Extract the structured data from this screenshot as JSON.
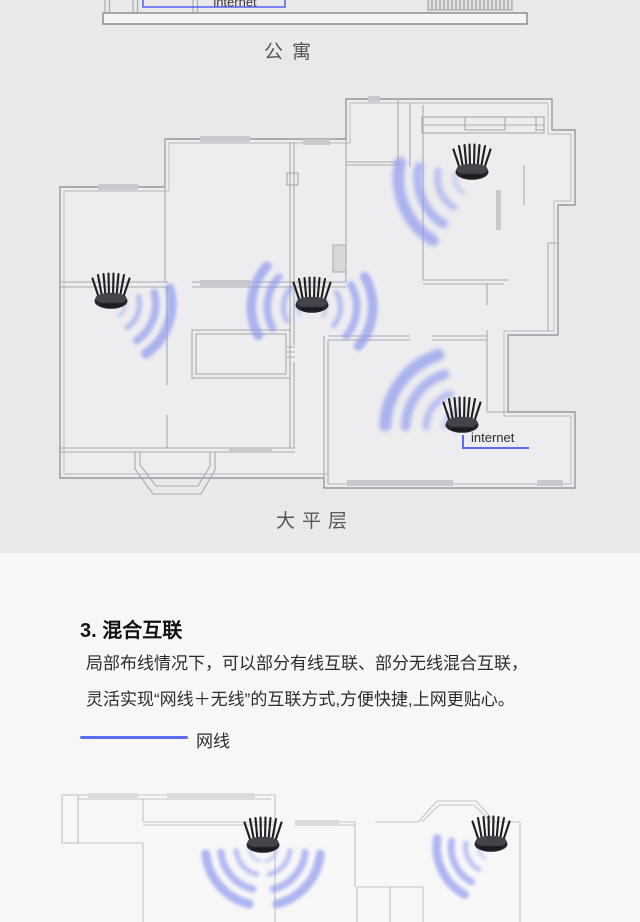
{
  "colors": {
    "accent_blue": "#5b6cf2",
    "wifi_wave": "#8e9aef",
    "background_top": "#e9e9ea",
    "background_bottom": "#f7f7f8",
    "wall_gray": "#a9abb1",
    "window_fill_gray": "#c8c9cc"
  },
  "apartment_plan": {
    "caption": "公寓",
    "internet_label": "internet"
  },
  "flat_plan": {
    "caption": "大平层",
    "internet_label": "internet",
    "router_count": 4
  },
  "hybrid_section": {
    "heading": "3. 混合互联",
    "body_line1": "局部布线情况下，可以部分有线互联、部分无线混合互联，",
    "body_line2": "灵活实现“网线＋无线”的互联方式,方便快捷,上网更贴心。",
    "legend_label": "网线"
  }
}
